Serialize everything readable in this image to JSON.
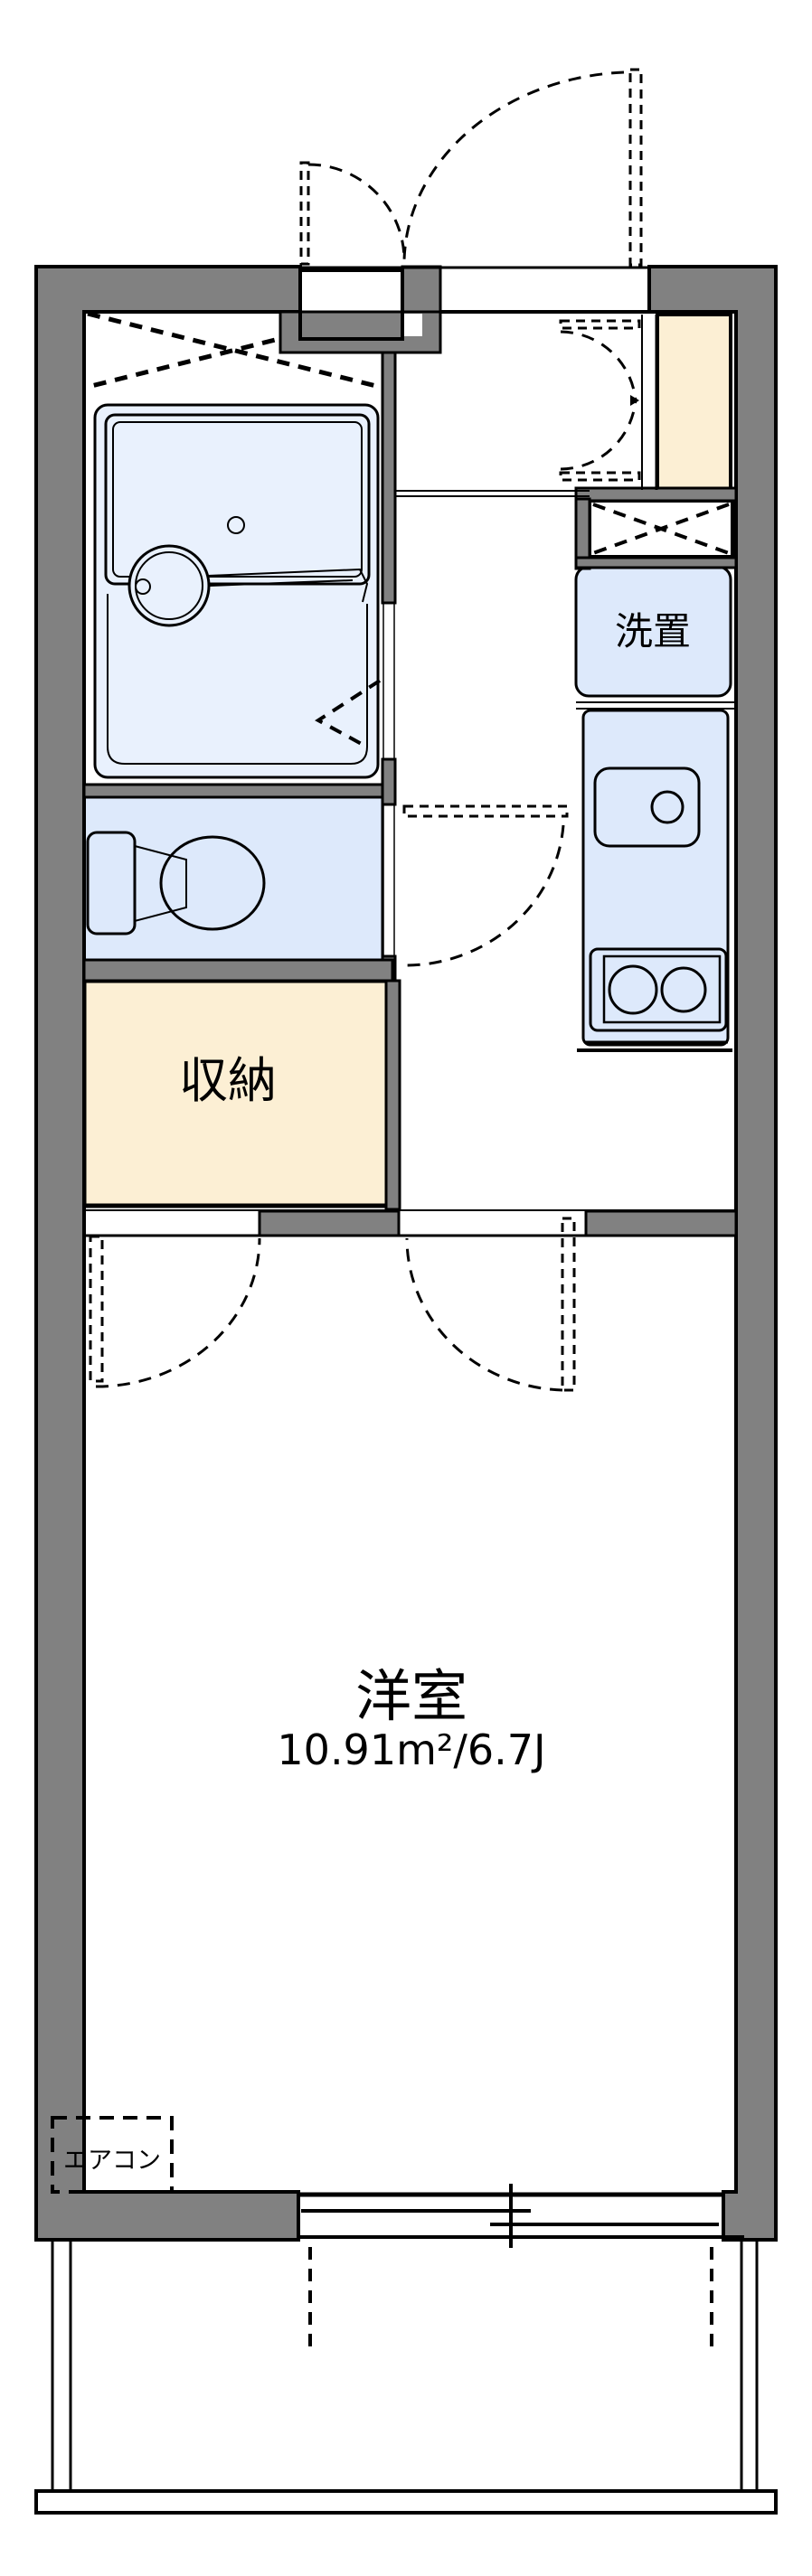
{
  "page": {
    "title": "間取り図"
  },
  "colors": {
    "wall_gray": "#818181",
    "outline": "#000000",
    "room_blue": "#dde9fb",
    "fixture_blue": "#e9f1fd",
    "closet_cream": "#fcefd4",
    "background": "#ffffff",
    "text": "#000000"
  },
  "labels": {
    "western_room": "洋室",
    "western_room_area": "10.91m²/6.7J",
    "storage": "収納",
    "washer_place": "洗置",
    "air_conditioner": "エアコン"
  },
  "features": [
    "entrance-door",
    "meter-box",
    "shoe-cabinet",
    "unit-bath",
    "bathtub",
    "washbasin",
    "folding-door",
    "toilet",
    "storage-closet",
    "ps-duct",
    "washer-space",
    "kitchen-sink",
    "gas-stove",
    "hall",
    "western-room",
    "double-doors",
    "air-conditioner",
    "sliding-window",
    "balcony"
  ]
}
